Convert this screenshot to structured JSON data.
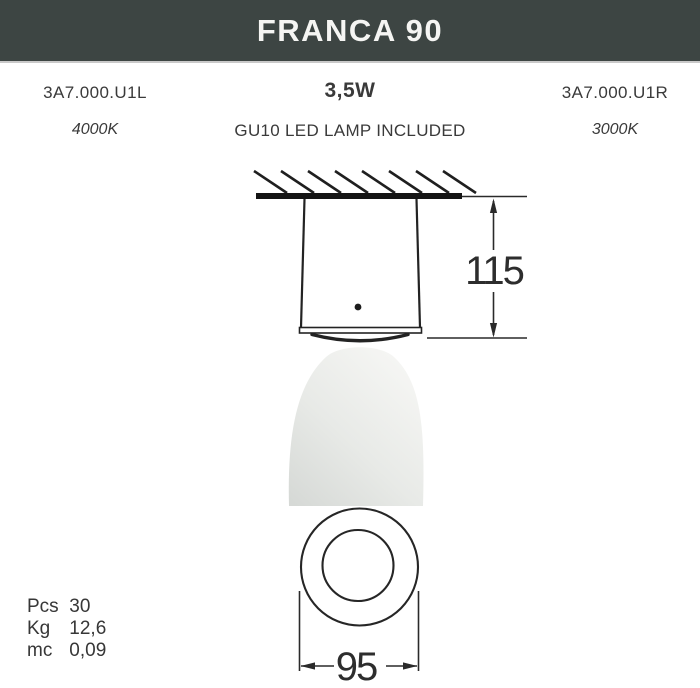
{
  "header": {
    "title": "FRANCA 90"
  },
  "info": {
    "code_left": "3A7.000.U1L",
    "wattage": "3,5W",
    "code_right": "3A7.000.U1R",
    "kelvin_left": "4000K",
    "lamp_included": "GU10 LED LAMP INCLUDED",
    "kelvin_right": "3000K"
  },
  "drawing": {
    "height_dim": "115",
    "diameter_dim": "95"
  },
  "packaging": {
    "rows": [
      {
        "label": "Pcs",
        "value": "30"
      },
      {
        "label": "Kg",
        "value": "12,6"
      },
      {
        "label": "mc",
        "value": "0,09"
      }
    ]
  },
  "colors": {
    "header_bg": "#3d4543",
    "header_text": "#f5f5f3",
    "line": "#262626",
    "text": "#3a3a3a",
    "beam_light": "#f7f7f5",
    "beam_dark": "#d6d9d6"
  }
}
